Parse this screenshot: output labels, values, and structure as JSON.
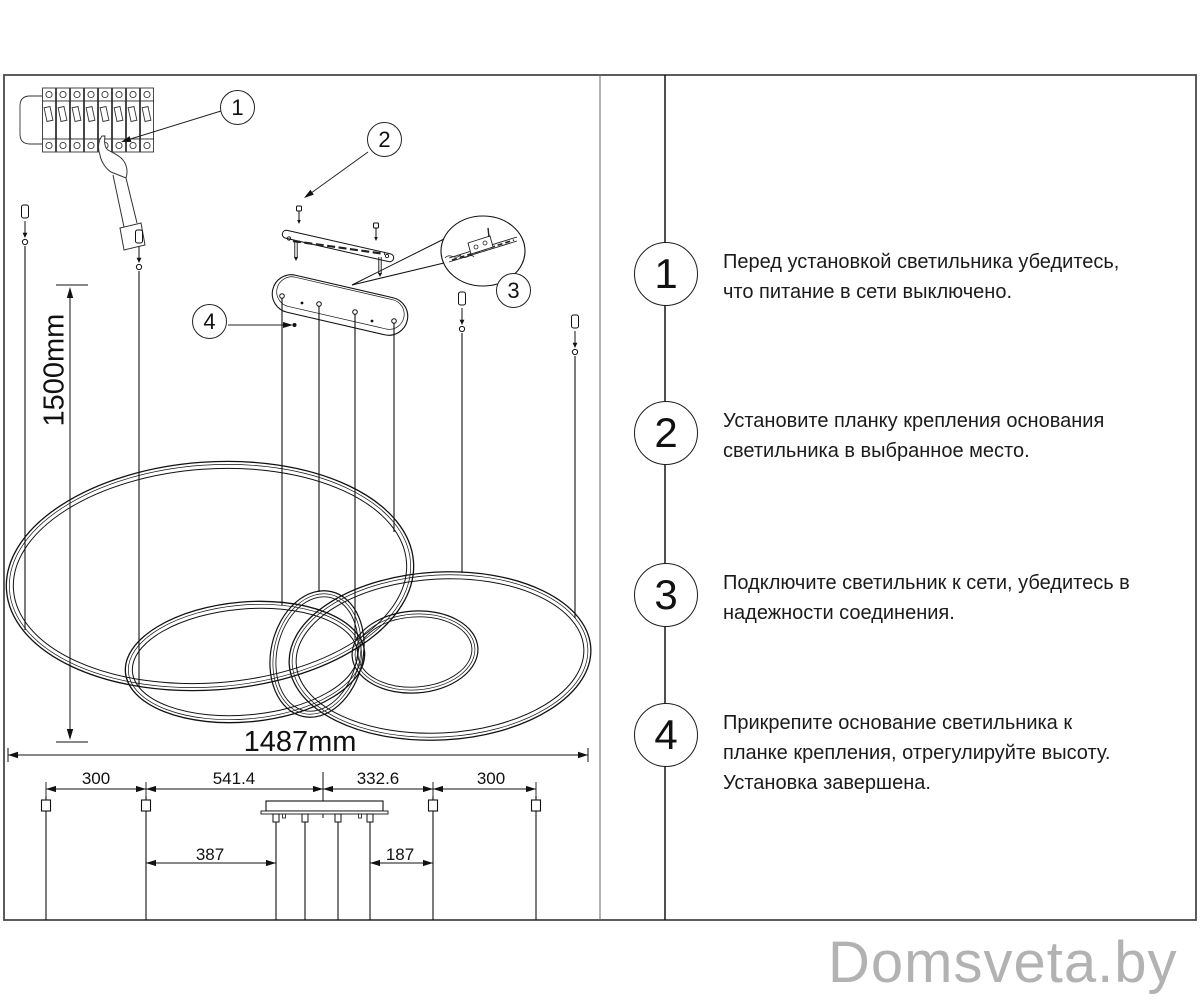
{
  "diagram": {
    "dimensions": {
      "drop_height": "1500mm",
      "total_width": "1487mm",
      "top_spacings": [
        "300",
        "541.4",
        "332.6",
        "300"
      ],
      "wire_offsets": [
        "387",
        "187"
      ]
    },
    "callouts": [
      "1",
      "2",
      "3",
      "4"
    ]
  },
  "instructions": [
    {
      "number": "1",
      "lines": [
        "Перед установкой светильника убедитесь,",
        "что питание в сети выключено."
      ]
    },
    {
      "number": "2",
      "lines": [
        "Установите планку крепления основания",
        "светильника в выбранное место."
      ]
    },
    {
      "number": "3",
      "lines": [
        "Подключите светильник к сети, убедитесь в",
        "надежности соединения."
      ]
    },
    {
      "number": "4",
      "lines": [
        "Прикрепите основание светильника к",
        "планке крепления, отрегулируйте высоту.",
        "Установка завершена."
      ]
    }
  ],
  "watermark": "Domsveta.by"
}
